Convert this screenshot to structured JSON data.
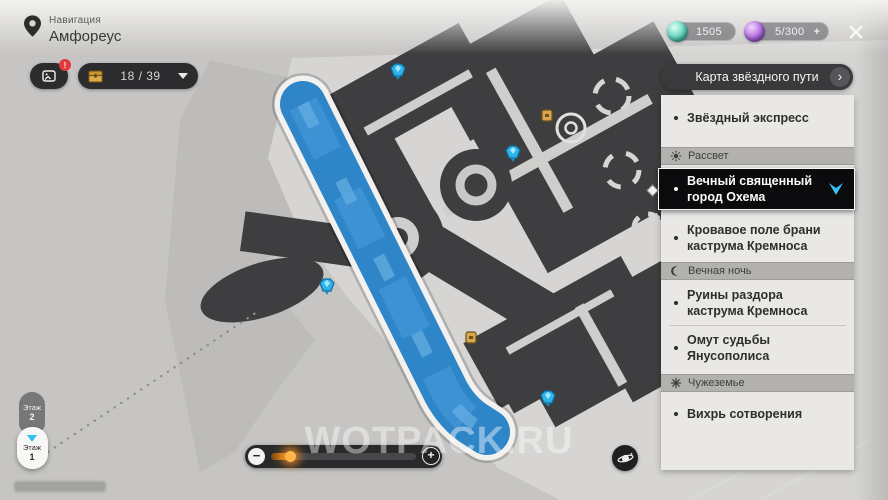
{
  "topbar": {
    "nav_label": "Навигация",
    "location_name": "Амфореус",
    "gallery_badge": "!",
    "chest_count": "18 / 39",
    "currencies": [
      {
        "name": "teal-orb-currency",
        "value": "1505",
        "color": "#5ed2bd"
      },
      {
        "name": "purple-orb-currency",
        "value": "5/300",
        "color": "#b06ae0",
        "add_label": "+"
      }
    ]
  },
  "panel": {
    "title": "Карта звёздного пути",
    "chevron": "›",
    "rows": [
      {
        "kind": "item",
        "lines": [
          "Звёздный экспресс"
        ]
      },
      {
        "kind": "section",
        "icon": "sun-icon",
        "label": "Рассвет"
      },
      {
        "kind": "item",
        "selected": true,
        "lines": [
          "Вечный священный",
          "город Охема"
        ]
      },
      {
        "kind": "item",
        "lines": [
          "Кровавое поле брани",
          "каструма Кремноса"
        ]
      },
      {
        "kind": "section",
        "icon": "moon-icon",
        "label": "Вечная ночь"
      },
      {
        "kind": "item",
        "lines": [
          "Руины раздора",
          "каструма Кремноса"
        ]
      },
      {
        "kind": "item",
        "lines": [
          "Омут судьбы",
          "Янусополиса"
        ]
      },
      {
        "kind": "section",
        "icon": "star-icon",
        "label": "Чужеземье"
      },
      {
        "kind": "item",
        "lines": [
          "Вихрь сотворения"
        ]
      }
    ]
  },
  "floor_selector": {
    "upper_label": "Этаж",
    "upper_value": "2",
    "lower_label": "Этаж",
    "lower_value": "1"
  },
  "zoom_slider": {
    "minus": "−",
    "plus": "+",
    "value_pct": 13
  },
  "map": {
    "watermark": "WOTPACK.RU",
    "road_color": "#2e86c9",
    "teleport_marker_color": "#2fb4e8",
    "chest_marker_color": "#d9a64e"
  }
}
